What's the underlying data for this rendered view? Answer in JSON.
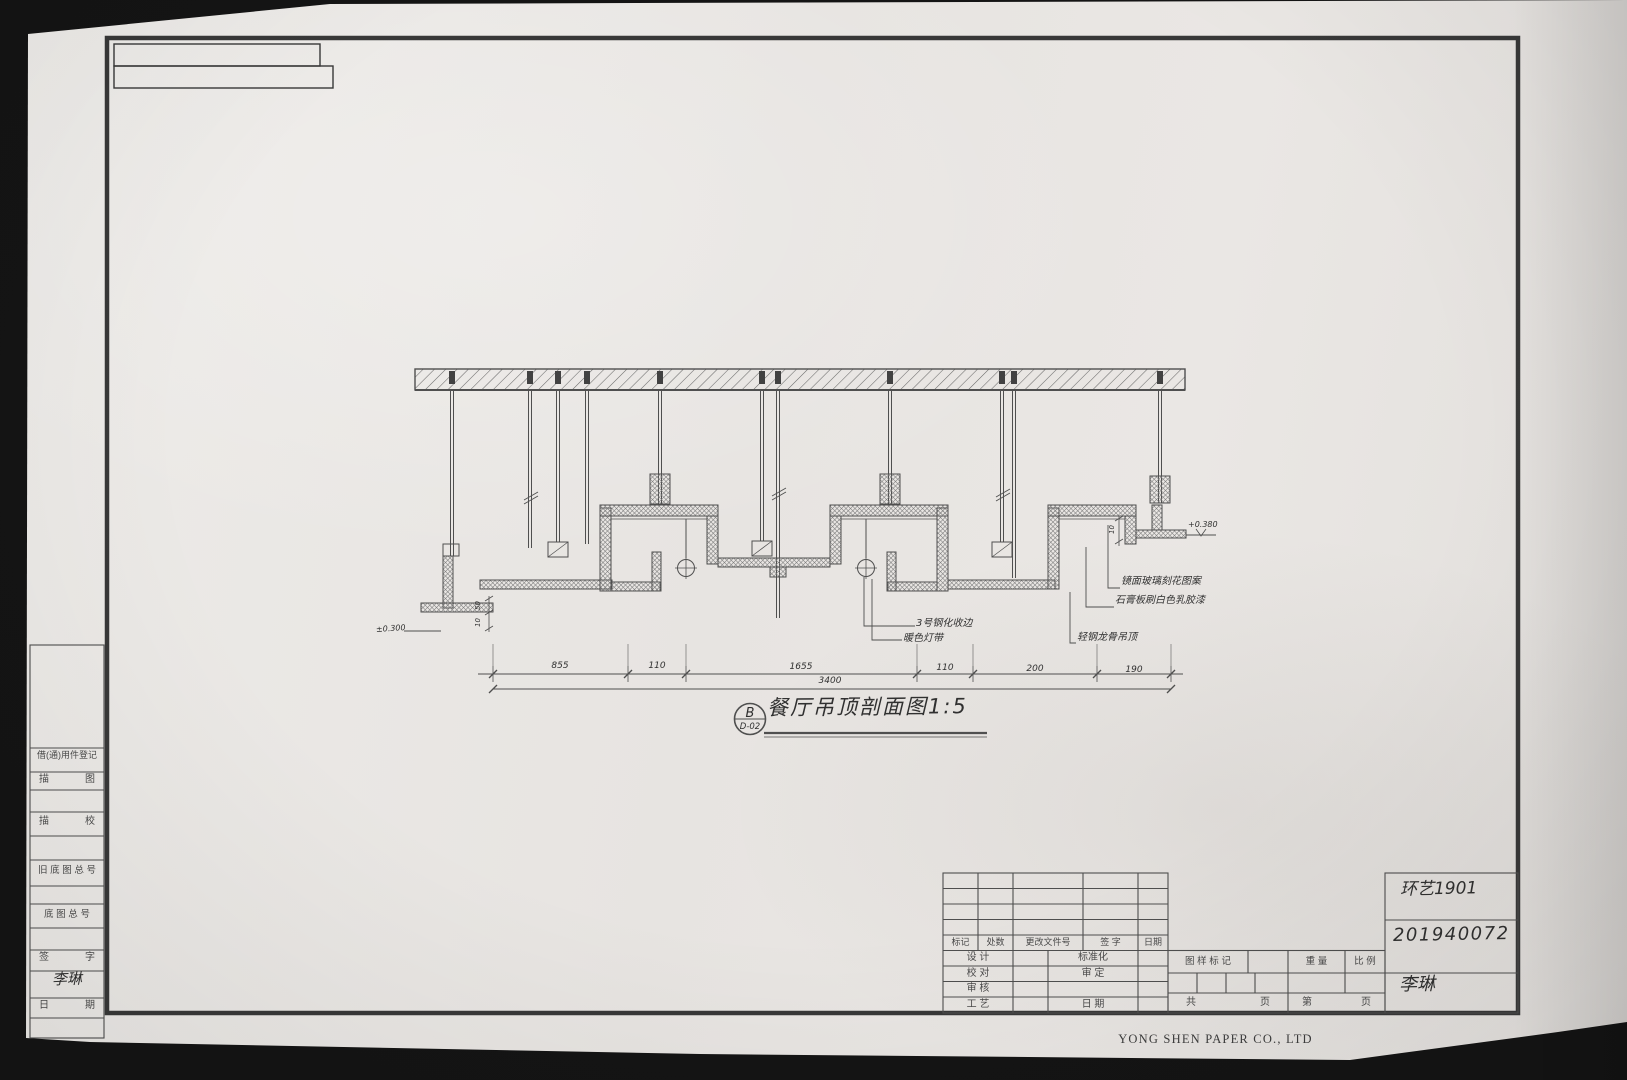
{
  "sheet": {
    "footer_company": "YONG SHEN PAPER CO., LTD"
  },
  "detail_title": {
    "bubble_letter": "B",
    "bubble_code": "D-02",
    "text": "餐厅吊顶剖面图1:5"
  },
  "annotations": {
    "left_elevation": "±0.300",
    "mid_1": "3号钢化收边",
    "mid_2": "暖色灯带",
    "right_1": "镜面玻璃刻花图案",
    "right_2": "石膏板刷白色乳胶漆",
    "right_3": "轻钢龙骨吊顶",
    "right_elevation": "+0.380"
  },
  "dimensions": {
    "seg_1": "855",
    "seg_2": "110",
    "seg_3": "1655",
    "seg_4": "110",
    "seg_5": "200",
    "seg_6": "190",
    "total": "3400",
    "small_1": "50",
    "small_2": "10",
    "small_3": "10"
  },
  "left_strip": {
    "row_1": "借(通)用件登记",
    "row_2_l": "描",
    "row_2_r": "图",
    "row_3_l": "描",
    "row_3_r": "校",
    "row_4": "旧 底 图 总 号",
    "row_5": "底 图 总 号",
    "row_6_l": "签",
    "row_6_r": "字",
    "row_6_value": "李琳",
    "row_7_l": "日",
    "row_7_r": "期"
  },
  "title_block": {
    "rev_c1": "标记",
    "rev_c2": "处数",
    "rev_c3": "更改文件号",
    "rev_c4": "签  字",
    "rev_c5": "日期",
    "design": "设  计",
    "standard": "标准化",
    "check": "校  对",
    "approve": "审  定",
    "audit": "审  核",
    "craft": "工  艺",
    "date_label": "日  期",
    "stamp_mark": "图 样 标 记",
    "weight": "重 量",
    "scale": "比 例",
    "pages_l1": "共",
    "pages_r1": "页",
    "pages_l2": "第",
    "pages_r2": "页",
    "hw_class": "环艺1901",
    "hw_student_id": "201940072",
    "hw_name": "李琳"
  }
}
